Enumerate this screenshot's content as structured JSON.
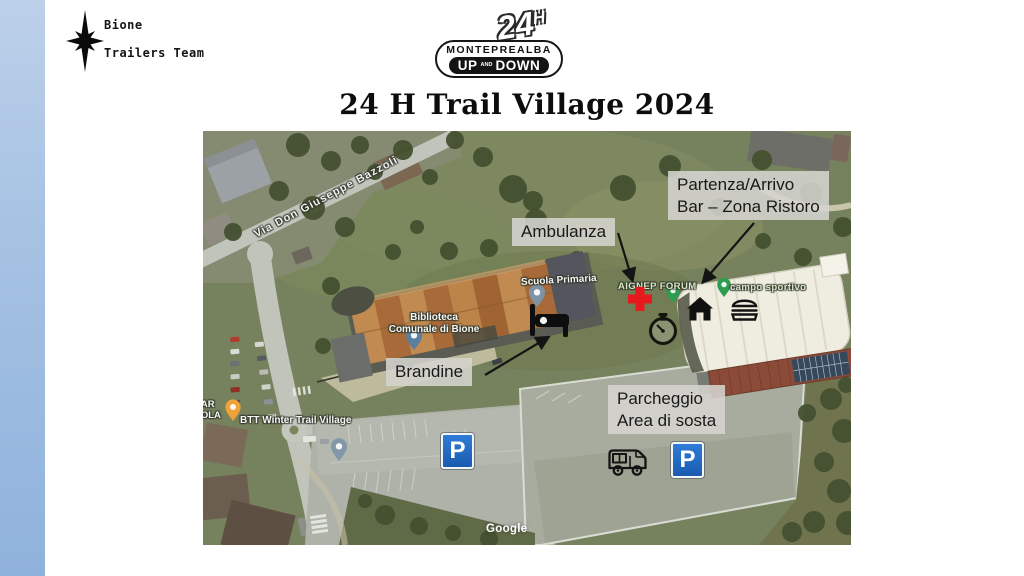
{
  "slide": {
    "title": "24 H Trail Village 2024"
  },
  "team_logo": {
    "line1": "Bione",
    "line2": "Trailers Team",
    "icon": "compass-star-icon"
  },
  "event_logo": {
    "hours": "24",
    "hours_unit": "H",
    "brand": "MONTEPREALBA",
    "up": "UP",
    "and": "AND",
    "down": "DOWN"
  },
  "map": {
    "attribution": "Google",
    "streets": {
      "via_bazzoli": "Via Don Giuseppe Bazzoli"
    },
    "pois": {
      "scuola": "Scuola Primaria",
      "biblioteca_line1": "Biblioteca",
      "biblioteca_line2": "Comunale di Bione",
      "aignep": "AIGNEP FORUM",
      "campo": "campo sportivo",
      "bar_line1": "BAR",
      "bar_line2": "COLA",
      "btt": "BTT Winter Trail Village"
    },
    "annotations": {
      "ambulanza": {
        "line1": "Ambulanza"
      },
      "partenza": {
        "line1": "Partenza/Arrivo",
        "line2": "Bar – Zona Ristoro"
      },
      "brandine": {
        "line1": "Brandine"
      },
      "parcheggio": {
        "line1": "Parcheggio",
        "line2": "Area di sosta"
      }
    },
    "parking_sign_letter": "P",
    "icon_names": [
      "red-cross-icon",
      "stopwatch-icon",
      "home-icon",
      "burger-icon",
      "bed-icon",
      "camper-icon",
      "parking-sign",
      "parking-sign"
    ]
  },
  "colors": {
    "strip_top": "#bcd0ea",
    "strip_bottom": "#8fb2dc",
    "note_bg": "#d5d4cf",
    "parking_blue": "#1d63bd",
    "cross_red": "#e6191d",
    "map_base_green": "#76815d"
  }
}
